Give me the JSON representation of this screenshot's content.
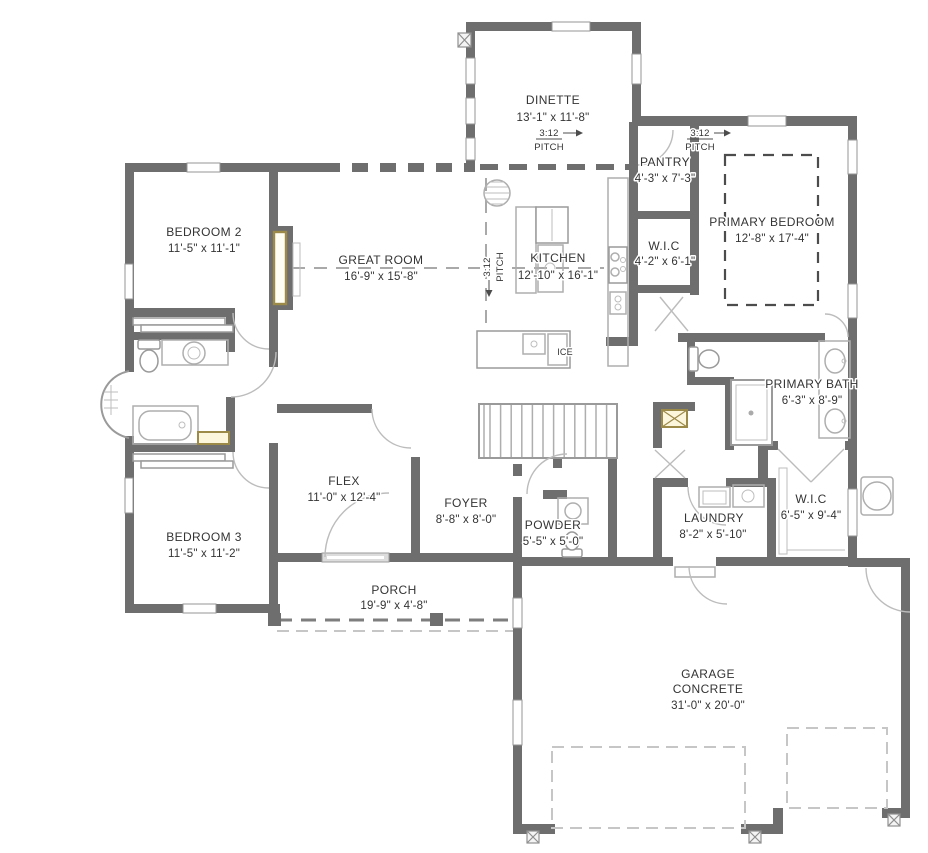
{
  "drawing": {
    "type": "residential floor plan"
  },
  "colors": {
    "wall": "#6e6e6e",
    "tan_accent": "#9c8a49",
    "tan_fill": "#fcf6dd",
    "fixture_line": "#aeaeae",
    "dashed_line": "#c6c6c6",
    "text": "#343434"
  },
  "rooms": [
    {
      "id": "dinette",
      "name": "DINETTE",
      "dims": "13'-1\" x 11'-8\""
    },
    {
      "id": "pantry",
      "name": "PANTRY",
      "dims": "4'-3\" x 7'-3\""
    },
    {
      "id": "primary-bedroom",
      "name": "PRIMARY BEDROOM",
      "dims": "12'-8\" x 17'-4\""
    },
    {
      "id": "wic-hall",
      "name": "W.I.C",
      "dims": "4'-2\" x 6'-1\""
    },
    {
      "id": "kitchen",
      "name": "KITCHEN",
      "dims": "12'-10\" x 16'-1\""
    },
    {
      "id": "great-room",
      "name": "GREAT ROOM",
      "dims": "16'-9\" x 15'-8\""
    },
    {
      "id": "bedroom-2",
      "name": "BEDROOM 2",
      "dims": "11'-5\" x 11'-1\""
    },
    {
      "id": "primary-bath",
      "name": "PRIMARY BATH",
      "dims": "6'-3\" x 8'-9\""
    },
    {
      "id": "flex",
      "name": "FLEX",
      "dims": "11'-0\" x 12'-4\""
    },
    {
      "id": "foyer",
      "name": "FOYER",
      "dims": "8'-8\" x 8'-0\""
    },
    {
      "id": "powder",
      "name": "POWDER",
      "dims": "5'-5\" x 5'-0\""
    },
    {
      "id": "laundry",
      "name": "LAUNDRY",
      "dims": "8'-2\" x 5'-10\""
    },
    {
      "id": "wic-primary",
      "name": "W.I.C",
      "dims": "6'-5\" x 9'-4\""
    },
    {
      "id": "bedroom-3",
      "name": "BEDROOM 3",
      "dims": "11'-5\" x 11'-2\""
    },
    {
      "id": "porch",
      "name": "PORCH",
      "dims": "19'-9\" x 4'-8\""
    },
    {
      "id": "garage",
      "name": "GARAGE",
      "material": "CONCRETE",
      "dims": "31'-0\" x 20'-0\""
    }
  ],
  "annotations": {
    "roof_pitch": {
      "ratio": "3:12",
      "label": "PITCH"
    },
    "ice_label": "ICE"
  }
}
